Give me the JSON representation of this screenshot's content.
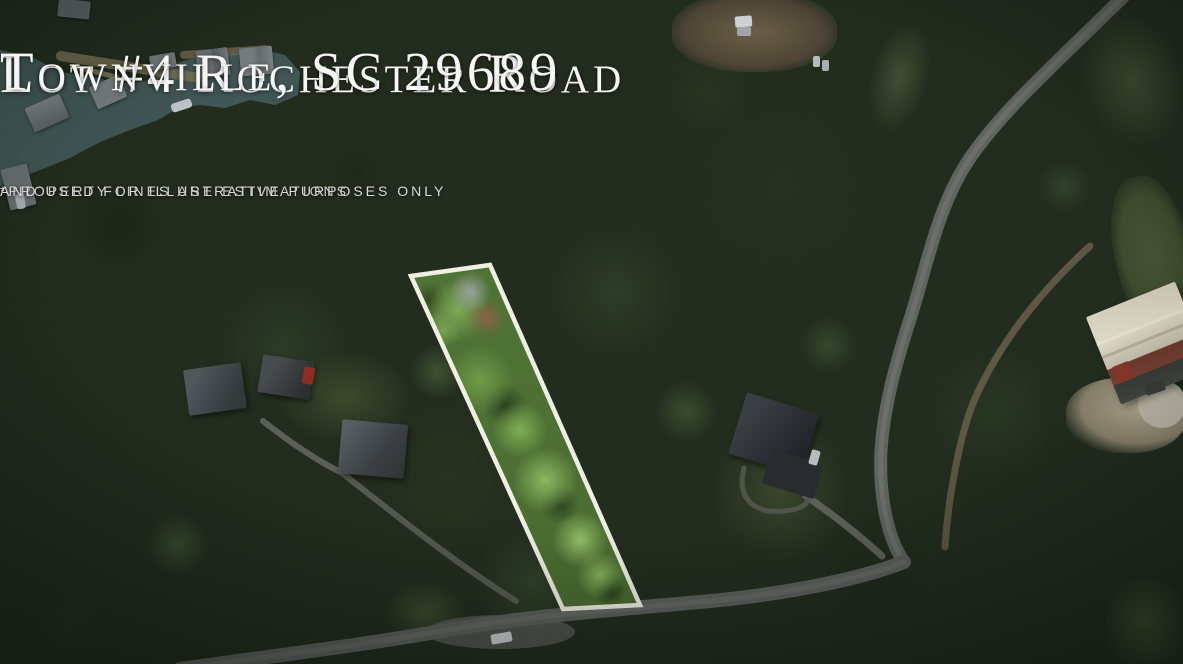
{
  "title": {
    "line1": "Lot #4 Rochester Road",
    "line2": "Townville, SC 29689"
  },
  "disclaimer": {
    "line1": "*PROPERTY LINES ARE ESTIMATIONS",
    "line2": "AND USED FOR ILLUSTRATIVE PURPOSES ONLY"
  },
  "colors": {
    "title_text": "#F6F6F4",
    "disclaimer_text": "#D9D9D7",
    "property_outline": "#F0EFE3",
    "lake_water": "#3C5150",
    "highlight_foliage": "#6F9C49"
  }
}
